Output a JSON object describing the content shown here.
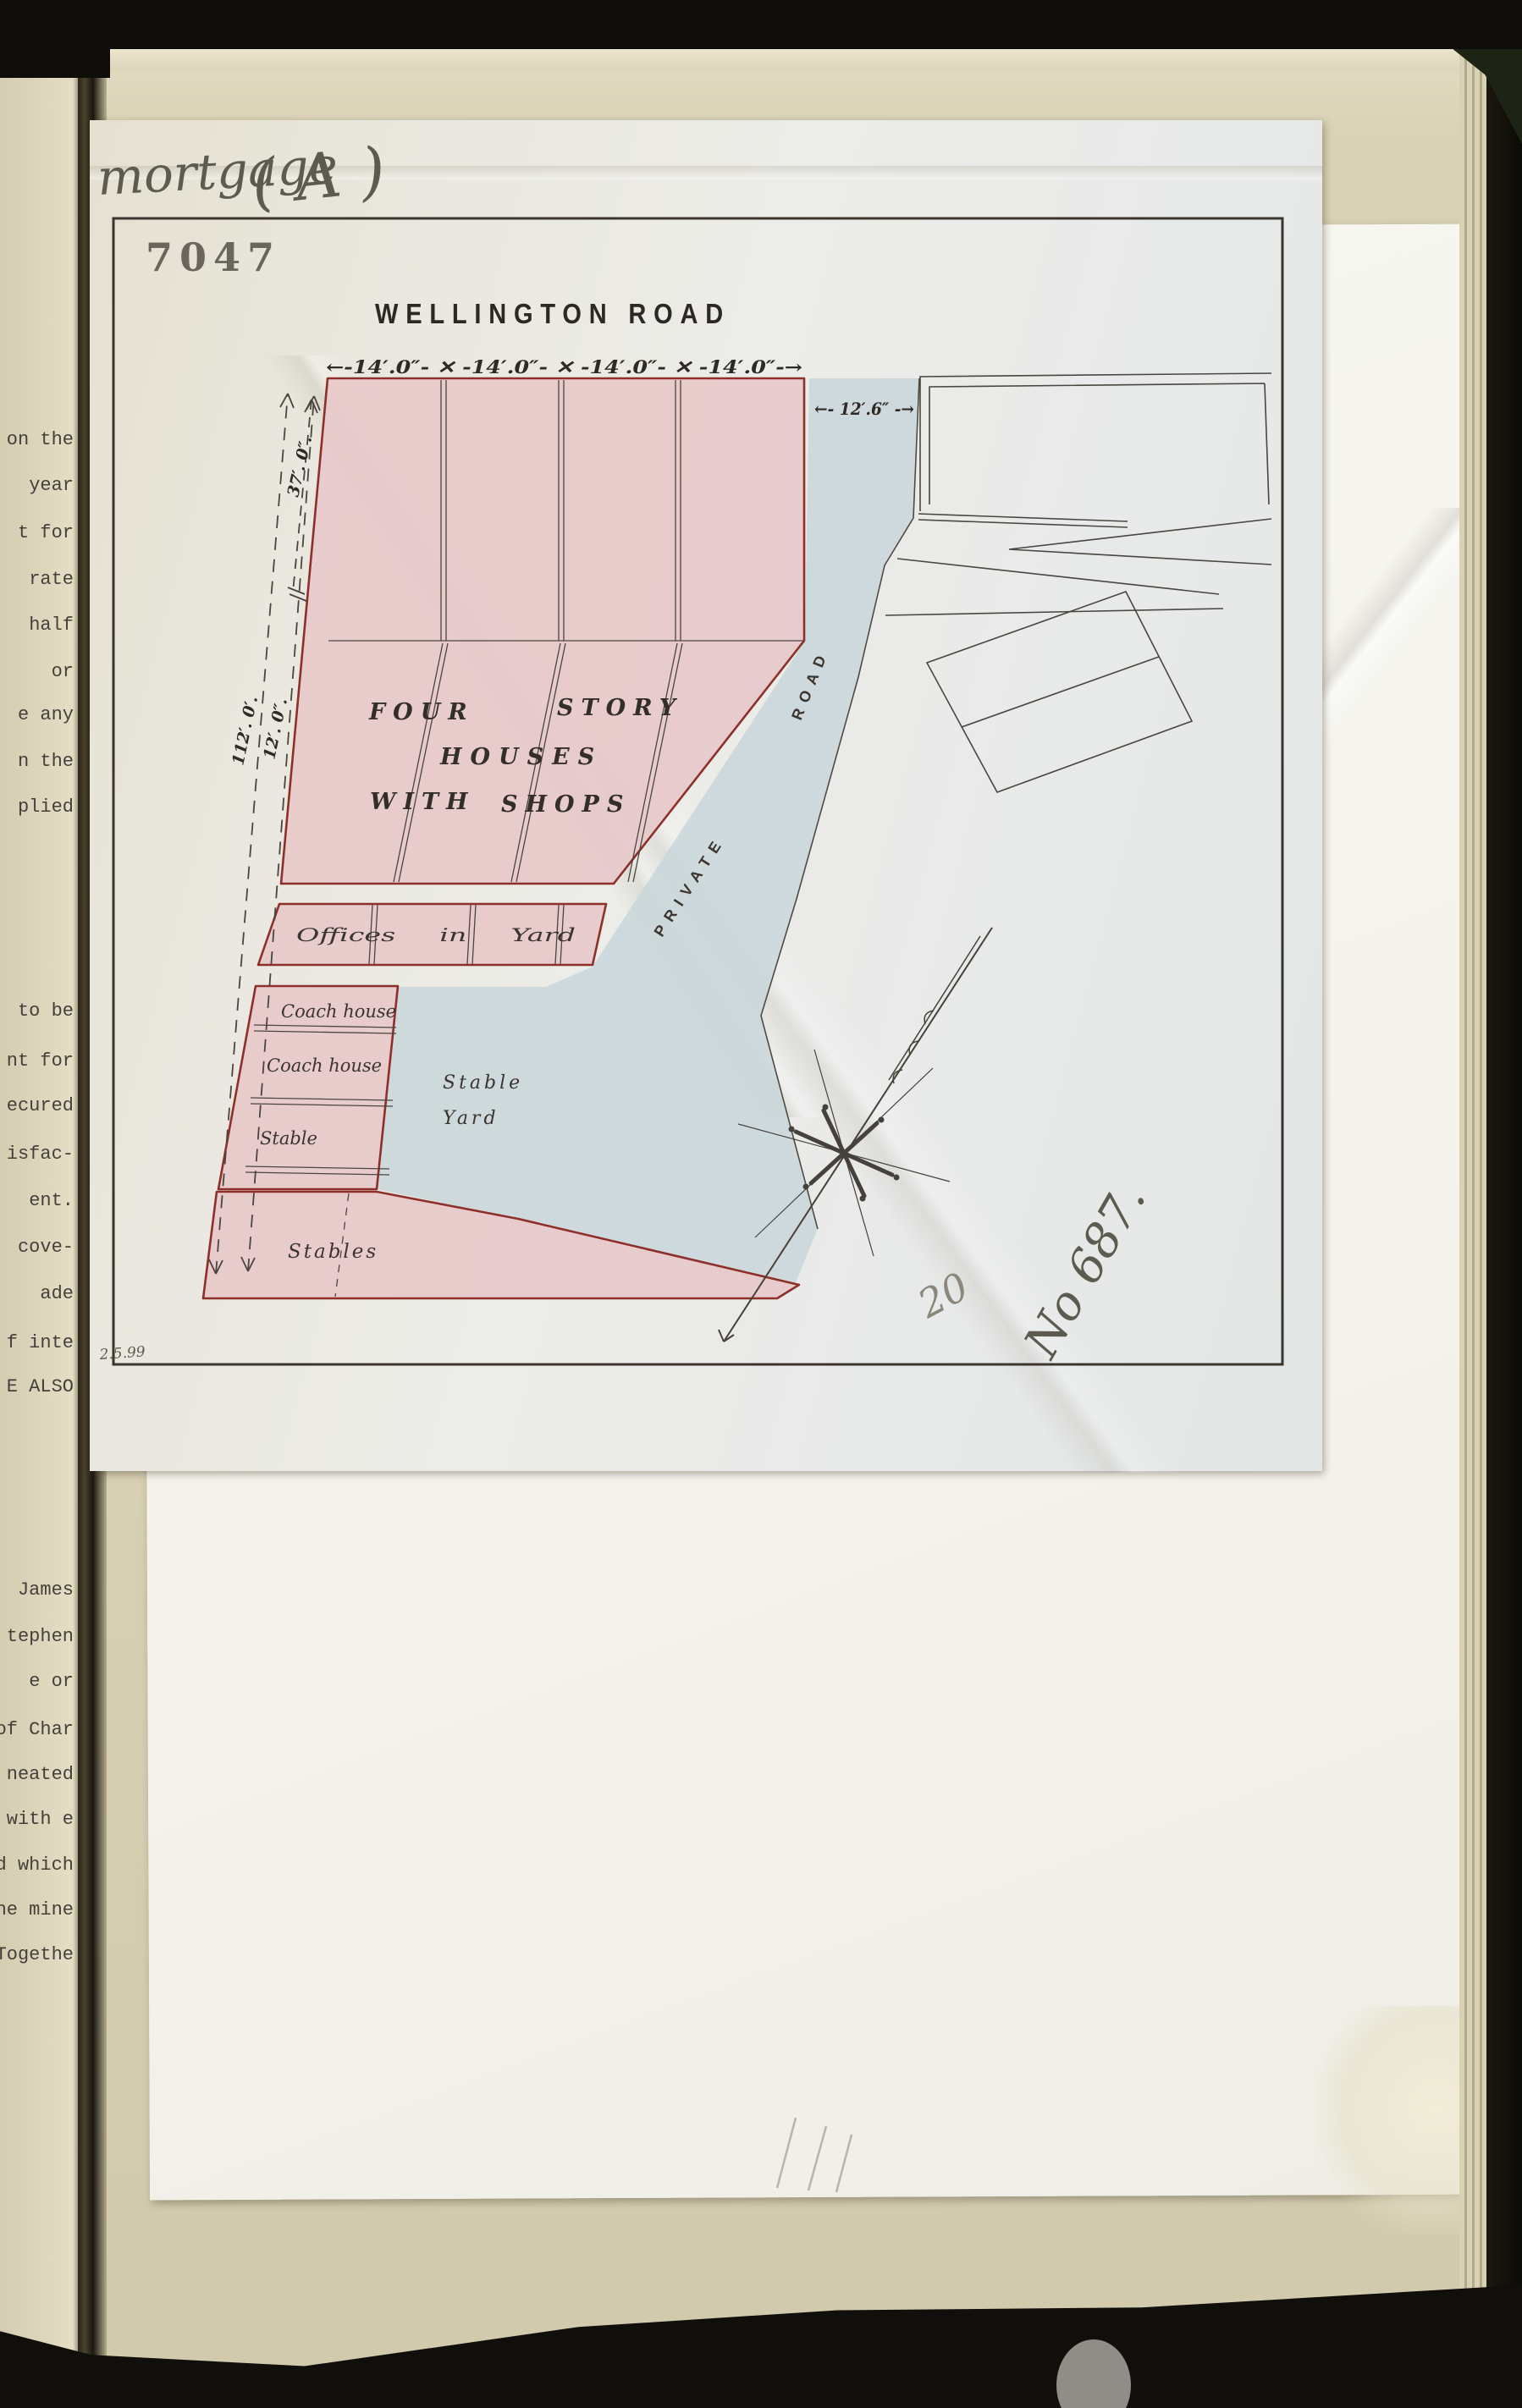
{
  "document": {
    "stamp_number": "7047",
    "survey_date": "2.5.99",
    "handwriting": {
      "mortgage_label": "mortgage",
      "class_mark": "( A )",
      "pencil_number": "20",
      "ink_number": "No 687."
    }
  },
  "plan": {
    "street_title": "WELLINGTON   ROAD",
    "dimensions": {
      "frontage_row": "←-14′.0″- ✕ -14′.0″- ✕ -14′.0″- ✕ -14′.0″-→",
      "road_gap": "←- 12′.6″ -→",
      "side_outer": "112′. 0′.",
      "side_middle": "12′. 0″.",
      "side_inner": "37′. 0″."
    },
    "labels": {
      "four": "FOUR",
      "story": "STORY",
      "houses": "HOUSES",
      "with": "WITH",
      "shops": "SHOPS",
      "offices": "Offices  in  Yard",
      "coach_house_1": "Coach house",
      "coach_house_2": "Coach house",
      "stable": "Stable",
      "stable_yard_1": "Stable",
      "stable_yard_2": "Yard",
      "stables": "Stables",
      "private": "PRIVATE",
      "road": "ROAD"
    }
  },
  "left_page": {
    "fragments": [
      "on the",
      "year",
      "t for",
      "rate",
      "half",
      "or",
      "e any",
      "n the",
      "plied",
      "to be",
      "nt for",
      "ecured",
      "isfac-",
      "ent.",
      "cove-",
      "ade",
      "f inte",
      "E ALSO",
      "James",
      "tephen",
      "e or",
      "of Char",
      "neated",
      "with e",
      "d which",
      "he mine",
      "Togethe"
    ]
  }
}
